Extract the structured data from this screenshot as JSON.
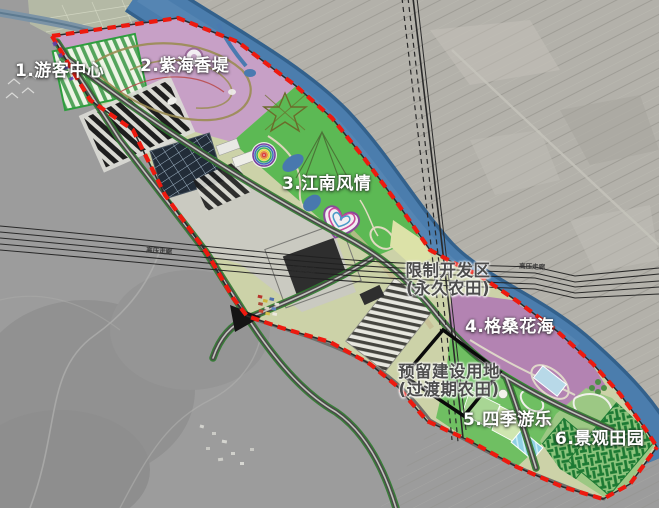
{
  "map": {
    "kind": "tourism-park-master-plan-over-satellite",
    "river_color": "#4b7dad",
    "boundary_color": "#ed1a0f",
    "zones": [
      {
        "label": "1.游客中心",
        "color": "#eef4e6"
      },
      {
        "label": "2.紫海香堤",
        "color": "#c7a0c6"
      },
      {
        "label": "3.江南风情",
        "color": "#5cb954"
      },
      {
        "label": "4.格桑花海",
        "color": "#b383b2"
      },
      {
        "label": "5.四季游乐",
        "color": "#6fbf62"
      },
      {
        "label": "6.景观田园",
        "color": "#9cc884"
      }
    ],
    "restricted_area": {
      "line1": "限制开发区",
      "line2": "(永久农田)"
    },
    "reserved_area": {
      "line1": "预留建设用地",
      "line2": "(过渡期农田)"
    },
    "corridor_label": "高压走廊"
  }
}
